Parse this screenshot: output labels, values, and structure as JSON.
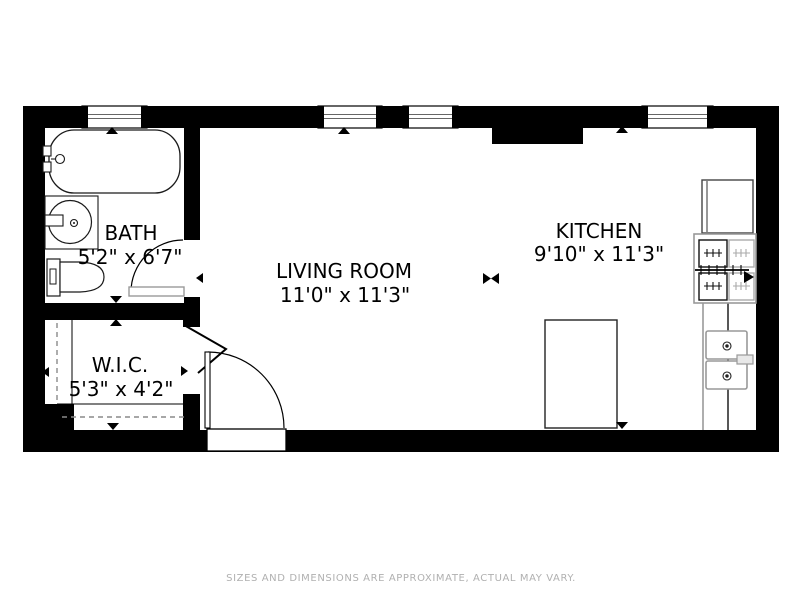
{
  "rooms": {
    "bath": {
      "name": "BATH",
      "dims": "5'2\" x 6'7\""
    },
    "living_room": {
      "name": "LIVING ROOM",
      "dims": "11'0\" x 11'3\""
    },
    "kitchen": {
      "name": "KITCHEN",
      "dims": "9'10\" x 11'3\""
    },
    "wic": {
      "name": "W.I.C.",
      "dims": "5'3\" x 4'2\""
    }
  },
  "footer": {
    "disclaimer": "SIZES AND DIMENSIONS ARE APPROXIMATE, ACTUAL MAY VARY."
  },
  "colors": {
    "wall": "#000000",
    "floor": "#ffffff",
    "fixture_outline": "#999999",
    "label_text": "#000000",
    "footer_text": "#b0b0b0"
  }
}
